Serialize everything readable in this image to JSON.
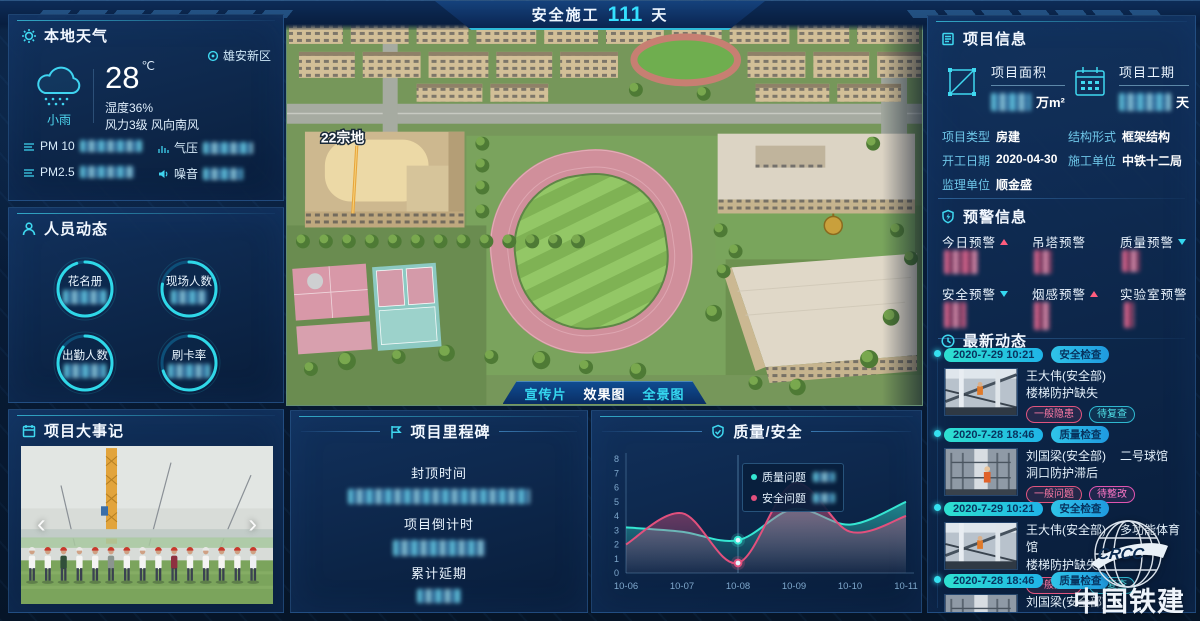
{
  "header": {
    "prefix": "安全施工",
    "days": "111",
    "suffix": "天"
  },
  "weather": {
    "title": "本地天气",
    "location": "雄安新区",
    "condition": "小雨",
    "temperature": "28",
    "temp_unit": "℃",
    "humidity": "湿度36%",
    "wind": "风力3级 风向南风",
    "metrics": [
      {
        "label": "PM 10"
      },
      {
        "label": "气压"
      },
      {
        "label": "PM2.5"
      },
      {
        "label": "噪音"
      }
    ]
  },
  "personnel": {
    "title": "人员动态",
    "gauges": [
      {
        "label": "花名册"
      },
      {
        "label": "现场人数"
      },
      {
        "label": "出勤人数"
      },
      {
        "label": "刷卡率"
      }
    ]
  },
  "events": {
    "title": "项目大事记"
  },
  "scene": {
    "land_label": "22宗地",
    "active_tab": "效果图",
    "tabs": [
      {
        "label": "宣传片"
      },
      {
        "label": "效果图"
      },
      {
        "label": "全景图"
      }
    ]
  },
  "milestone": {
    "title": "项目里程碑",
    "items": [
      {
        "label": "封顶时间"
      },
      {
        "label": "项目倒计时"
      },
      {
        "label": "累计延期"
      }
    ]
  },
  "project_info": {
    "title": "项目信息",
    "stats": [
      {
        "label": "项目面积",
        "unit": "万m²"
      },
      {
        "label": "项目工期",
        "unit": "天"
      }
    ],
    "fields": [
      {
        "label": "项目类型",
        "value": "房建"
      },
      {
        "label": "结构形式",
        "value": "框架结构"
      },
      {
        "label": "开工日期",
        "value": "2020-04-30"
      },
      {
        "label": "施工单位",
        "value": "中铁十二局"
      },
      {
        "label": "监理单位",
        "value": "顺金盛"
      }
    ]
  },
  "warnings": {
    "title": "预警信息",
    "items": [
      {
        "label": "今日预警",
        "trend": "up"
      },
      {
        "label": "吊塔预警",
        "trend": "none"
      },
      {
        "label": "质量预警",
        "trend": "down"
      },
      {
        "label": "安全预警",
        "trend": "down"
      },
      {
        "label": "烟感预警",
        "trend": "up"
      },
      {
        "label": "实验室预警",
        "trend": "none"
      }
    ]
  },
  "updates": {
    "title": "最新动态",
    "items": [
      {
        "date": "2020-7-29 10:21",
        "category": "安全检查",
        "person": "王大伟(安全部)",
        "place": "",
        "issue": "楼梯防护缺失",
        "tags": [
          {
            "text": "一般隐患"
          },
          {
            "text": "待复查"
          }
        ]
      },
      {
        "date": "2020-7-28 18:46",
        "category": "质量检查",
        "person": "刘国梁(安全部)",
        "place": "二号球馆",
        "issue": "洞口防护滞后",
        "tags": [
          {
            "text": "一般问题"
          },
          {
            "text": "待整改"
          }
        ]
      },
      {
        "date": "2020-7-29 10:21",
        "category": "安全检查",
        "person": "王大伟(安全部)",
        "place": "多功能体育馆",
        "issue": "楼梯防护缺失",
        "tags": [
          {
            "text": "一般隐患"
          },
          {
            "text": "待复查"
          }
        ]
      },
      {
        "date": "2020-7-28 18:46",
        "category": "质量检查",
        "person": "刘国梁(安全部)",
        "place": "",
        "issue": "",
        "tags": []
      }
    ]
  },
  "logo": {
    "text_en": "CRCC",
    "text_cn": "中国铁建"
  },
  "colors": {
    "accent": "#35d8f0",
    "teal": "#35e6d2",
    "pink": "#e2507d",
    "gold": "#e8a63c"
  },
  "chart_data": {
    "type": "line",
    "title": "质量/安全",
    "x": [
      "10-06",
      "10-07",
      "10-08",
      "10-09",
      "10-10",
      "10-11"
    ],
    "series": [
      {
        "name": "质量问题",
        "color": "#35e6d2",
        "values": [
          3.2,
          2.9,
          2.3,
          4.5,
          3.4,
          5.0
        ]
      },
      {
        "name": "安全问题",
        "color": "#e2507d",
        "values": [
          2.0,
          4.2,
          0.7,
          6.3,
          2.9,
          4.0
        ]
      }
    ],
    "ylim": [
      0,
      8
    ],
    "yticks": [
      0,
      1,
      2,
      3,
      4,
      5,
      6,
      7,
      8
    ],
    "highlight_x": "10-08",
    "grid": false,
    "legend_position": "tooltip-at-highlight"
  }
}
